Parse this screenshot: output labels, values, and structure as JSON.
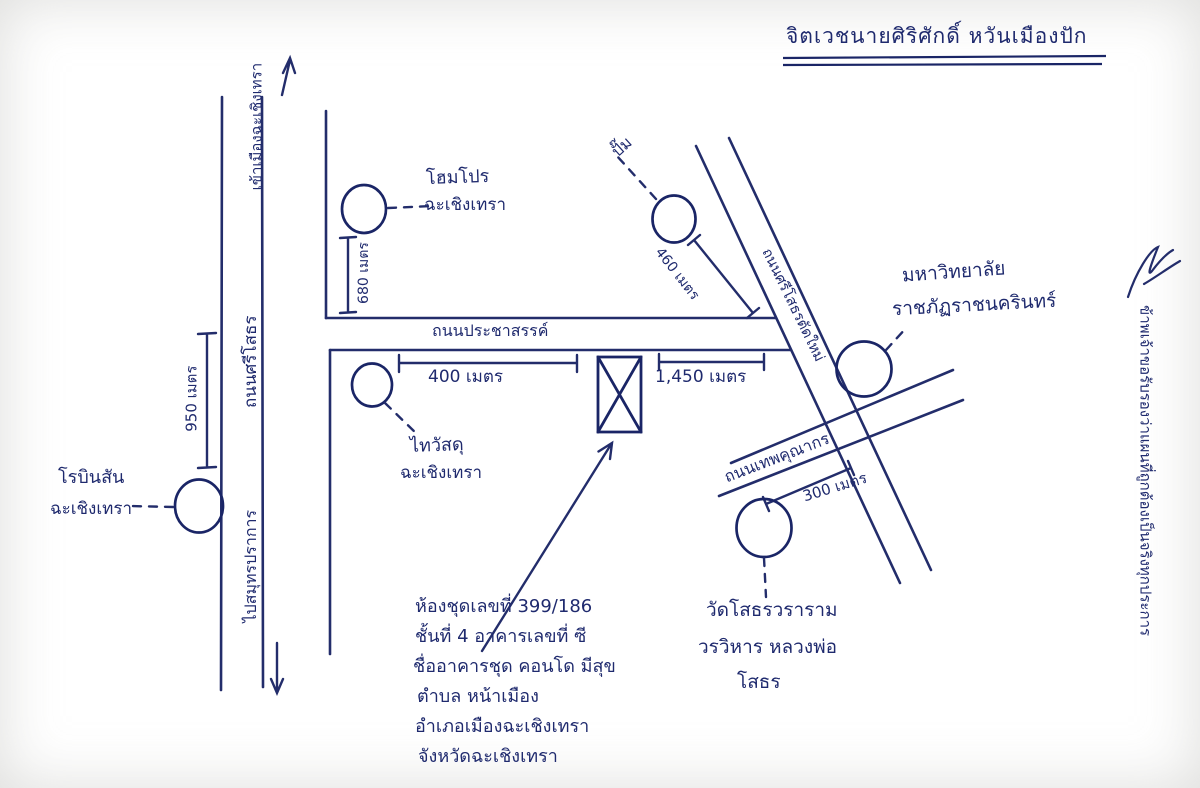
{
  "title": {
    "text": "จิตเวชนายศิริศักดิ์ หวันเมืองปัก"
  },
  "ink_color": "#1f2a6e",
  "roads": {
    "prachasan": "ถนนประชาสรรค์",
    "si_sothon": "ถนนศรีโสธร",
    "si_sothon_new": "ถนนศรีโสธรตัดใหม่",
    "thep_khunakon": "ถนนเทพคุณากร"
  },
  "directions": {
    "enter_city": "เข้าเมืองฉะเชิงเทรา",
    "to_samut_prakan": "ไปสมุทรปราการ"
  },
  "landmarks": {
    "homepro": {
      "line1": "โฮมโปร",
      "line2": "ฉะเชิงเทรา"
    },
    "robinson": {
      "line1": "โรบินสัน",
      "line2": "ฉะเชิงเทรา"
    },
    "thai_watsadu": {
      "line1": "ไทวัสดุ",
      "line2": "ฉะเชิงเทรา"
    },
    "gas_station": {
      "line1": "ปั๊ม"
    },
    "university": {
      "line1": "มหาวิทยาลัย",
      "line2": "ราชภัฏราชนครินทร์"
    },
    "temple": {
      "line1": "วัดโสธรวราราม",
      "line2": "วรวิหาร หลวงพ่อ",
      "line3": "โสธร"
    }
  },
  "dimensions": {
    "d950": "950 เมตร",
    "d680": "680 เมตร",
    "d400": "400 เมตร",
    "d1450": "1,450 เมตร",
    "d460": "460 เมตร",
    "d300": "300 เมตร"
  },
  "property": {
    "address_lines": [
      "ห้องชุดเลขที่ 399/186",
      "ชั้นที่ 4 อาคารเลขที่ ซี",
      "ชื่ออาคารชุด คอนโด มีสุข",
      "ตำบล หน้าเมือง",
      "อำเภอเมืองฉะเชิงเทรา",
      "จังหวัดฉะเชิงเทรา"
    ]
  },
  "margin_note": {
    "text": "ข้าพเจ้าขอรับรองว่าแผนที่ถูกต้องเป็นจริงทุกประการ"
  }
}
